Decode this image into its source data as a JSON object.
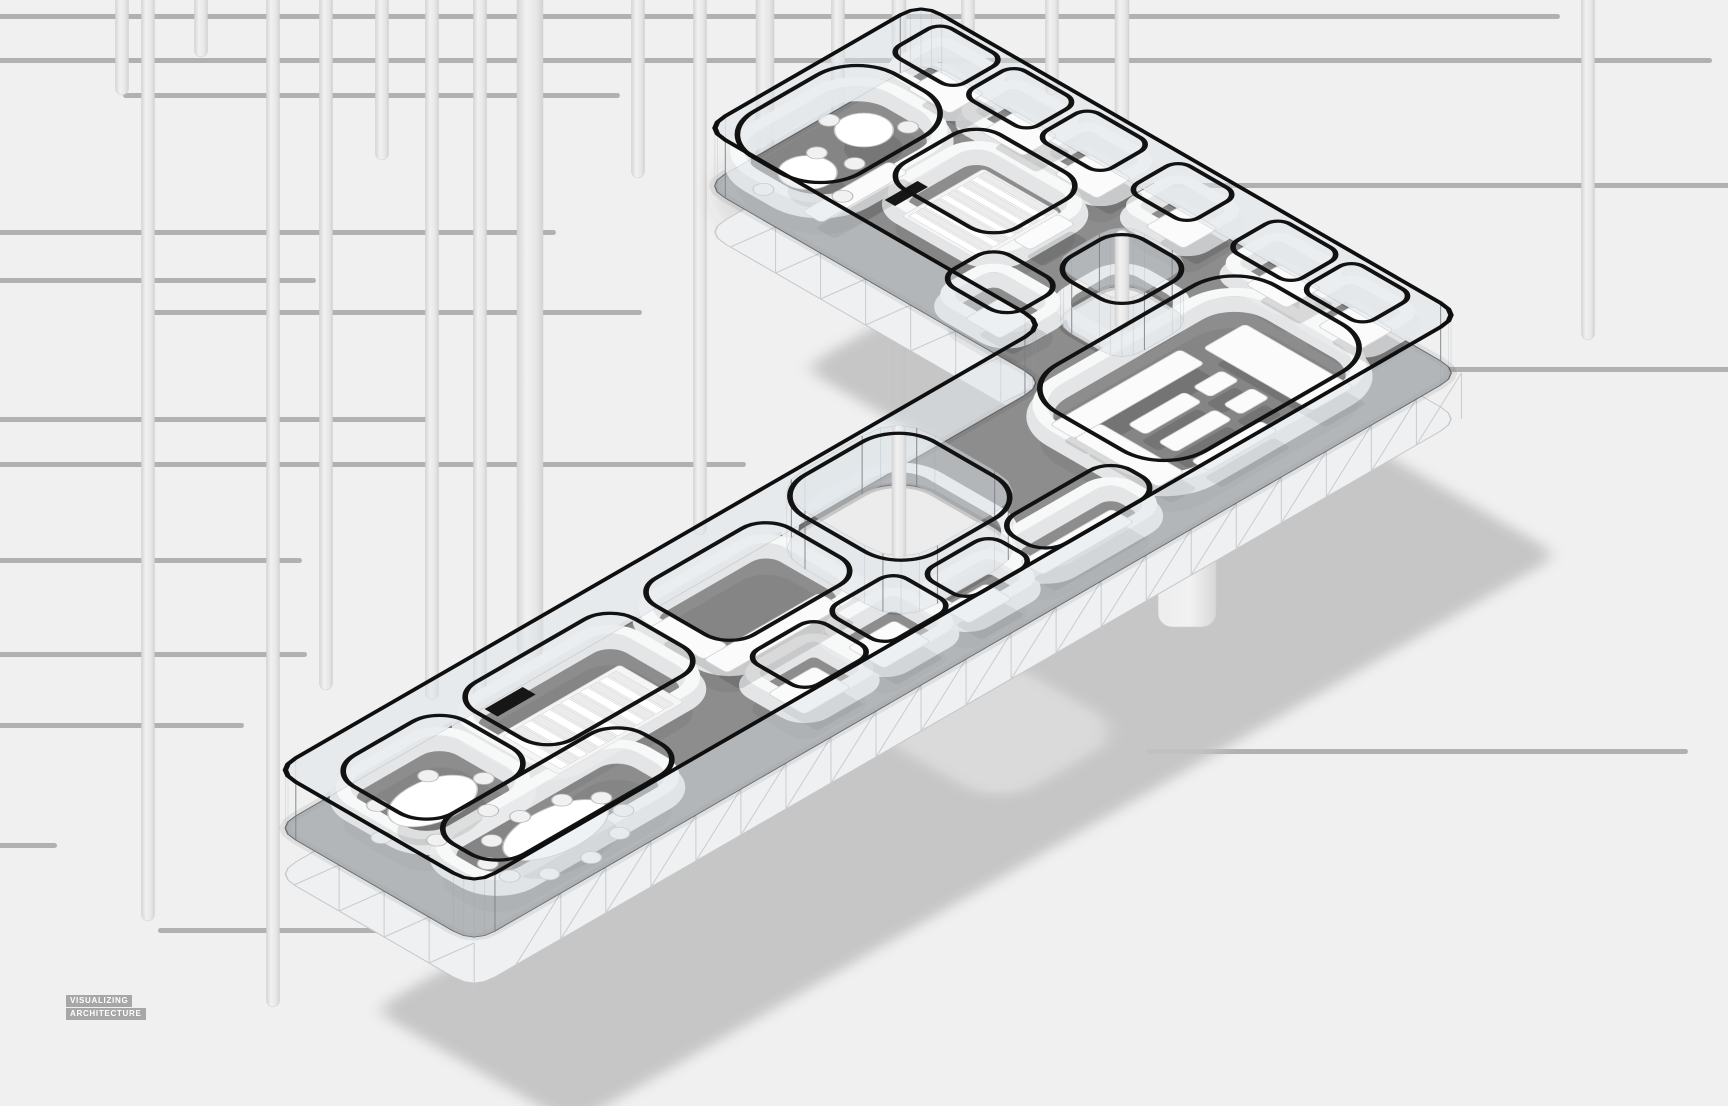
{
  "watermark": {
    "line1": "VISUALIZING",
    "line2": "ARCHITECTURE"
  },
  "palette": {
    "bg": "#f0f0f0",
    "h_line": "#b1b1b1",
    "rod_edge": "#d6d6d6",
    "rod_mid": "#f1f1f1",
    "floor": "#8d8d8d",
    "floor_edge": "rgba(35,35,35,0.75)",
    "wall_band": "#e9eaeb",
    "wall_hi": "#f7f8f8",
    "outline": "#121212",
    "rail": "#0f0f0f",
    "glass": "rgba(222,228,233,0.48)",
    "post": "rgba(118,124,130,0.75)",
    "fascia": "#eef0f2",
    "fascia_stroke": "#c5c8cb",
    "truss": "#c9cccf",
    "void_ground": "#ececec",
    "furn": "#fbfbfb",
    "furn_stroke": "#d4d6d8",
    "furn_shadow": "rgba(0,0,0,0.12)",
    "table": "#ffffff",
    "table_stroke": "#c6c6c6",
    "chair": "#f1f1f1",
    "chair_stroke": "#b9b9b9",
    "step_a": "#ffffff",
    "step_b": "#ececec",
    "step_stroke": "#d9d9d9",
    "black_bar": "#161616",
    "shadow": "#c3c3c3",
    "shadow_hole": "#d9d9d9",
    "pier_a": "#ededed",
    "pier_b": "#d7d7d7",
    "band_shadow": "rgba(70,70,70,0.12)",
    "wm_bg": "#a7a7a7",
    "wm_fg": "#ffffff"
  },
  "scene": {
    "proj": {
      "e": 275,
      "f": 770,
      "z_rail": 0,
      "z_outline": 6,
      "z_hi": 22,
      "z_band": 34,
      "z_floor": 58,
      "z_slab": 104
    },
    "background": {
      "h_lines": [
        [
          14,
          -20,
          1560
        ],
        [
          58,
          -20,
          1712
        ],
        [
          93,
          123,
          620
        ],
        [
          183,
          1030,
          1740
        ],
        [
          230,
          -20,
          556
        ],
        [
          278,
          -20,
          316
        ],
        [
          310,
          145,
          642
        ],
        [
          367,
          1330,
          1740
        ],
        [
          417,
          -20,
          436
        ],
        [
          462,
          -20,
          746
        ],
        [
          558,
          -20,
          302
        ],
        [
          652,
          -20,
          307
        ],
        [
          723,
          -20,
          244
        ],
        [
          749,
          1146,
          1688
        ],
        [
          843,
          -20,
          57
        ],
        [
          928,
          158,
          393
        ]
      ],
      "v_rods": [
        [
          122,
          -15,
          95,
          13
        ],
        [
          148,
          -15,
          921,
          13
        ],
        [
          201,
          -15,
          57,
          13
        ],
        [
          273,
          -15,
          1007,
          13
        ],
        [
          326,
          -15,
          690,
          13
        ],
        [
          382,
          -15,
          160,
          13
        ],
        [
          432,
          -15,
          700,
          13
        ],
        [
          480,
          -15,
          700,
          13
        ],
        [
          530,
          -15,
          660,
          26
        ],
        [
          638,
          -15,
          178,
          13
        ],
        [
          700,
          -15,
          535,
          13
        ],
        [
          765,
          -15,
          160,
          18
        ],
        [
          838,
          -15,
          150,
          13
        ],
        [
          899,
          -15,
          420,
          14
        ],
        [
          968,
          -15,
          40,
          13
        ],
        [
          1052,
          -15,
          95,
          13
        ],
        [
          1122,
          -15,
          125,
          14
        ],
        [
          1588,
          -15,
          340,
          13
        ]
      ],
      "band_shadow": {
        "x1": 750,
        "y1": 195,
        "x2": 1035,
        "y2": 360,
        "w": 70
      }
    },
    "shadow": {
      "dx": 98,
      "dy": 240,
      "blur": 7,
      "opacity": 0.92
    },
    "pier": {
      "x": 1158,
      "y": 545,
      "w": 58,
      "h": 82,
      "r": 14
    },
    "plate": {
      "outline": {
        "pts": [
          [
            0,
            0
          ],
          [
            890,
            0
          ],
          [
            890,
            -394
          ],
          [
            1140,
            -394
          ],
          [
            1140,
            230
          ],
          [
            0,
            230
          ]
        ],
        "r": 24
      },
      "post_spacing": 46,
      "truss_spacing": 52,
      "voids": [
        {
          "rect": [
            565,
            5,
            715,
            158
          ],
          "r": 42
        },
        {
          "rect": [
            954,
            -60,
            1038,
            24
          ],
          "r": 26
        }
      ],
      "rooms": [
        {
          "rect": [
            35,
            25,
            165,
            140
          ],
          "r": 32
        },
        {
          "rect": [
            35,
            140,
            255,
            222
          ],
          "r": 32
        },
        {
          "rect": [
            180,
            22,
            365,
            135
          ],
          "r": 30
        },
        {
          "rect": [
            390,
            22,
            545,
            135
          ],
          "r": 28
        },
        {
          "rect": [
            390,
            152,
            470,
            222
          ],
          "r": 16
        },
        {
          "rect": [
            482,
            152,
            562,
            222
          ],
          "r": 16
        },
        {
          "rect": [
            574,
            170,
            654,
            224
          ],
          "r": 16
        },
        {
          "rect": [
            666,
            165,
            800,
            224
          ],
          "r": 24
        },
        {
          "rect": [
            815,
            40,
            1068,
            212
          ],
          "r": 48
        },
        {
          "rect": [
            1078,
            20,
            1138,
            95
          ],
          "r": 14
        },
        {
          "rect": [
            1078,
            105,
            1138,
            178
          ],
          "r": 14
        },
        {
          "rect": [
            895,
            -388,
            1060,
            -265
          ],
          "r": 46
        },
        {
          "rect": [
            950,
            -250,
            1060,
            -120
          ],
          "r": 28
        },
        {
          "rect": [
            880,
            -115,
            945,
            -35
          ],
          "r": 20
        },
        {
          "rect": [
            1078,
            -370,
            1138,
            -295
          ],
          "r": 14
        },
        {
          "rect": [
            1078,
            -285,
            1138,
            -210
          ],
          "r": 14
        },
        {
          "rect": [
            1078,
            -200,
            1138,
            -125
          ],
          "r": 14
        },
        {
          "rect": [
            1078,
            -95,
            1138,
            -25
          ],
          "r": 14
        }
      ],
      "furniture": [
        [
          403,
          166,
          457,
          208
        ],
        [
          495,
          166,
          549,
          208
        ],
        [
          589,
          182,
          639,
          212
        ],
        [
          680,
          180,
          786,
          206
        ],
        [
          400,
          95,
          533,
          122
        ],
        [
          400,
          32,
          428,
          95
        ],
        [
          835,
          60,
          985,
          88
        ],
        [
          835,
          88,
          865,
          185
        ],
        [
          1000,
          72,
          1048,
          198
        ],
        [
          880,
          105,
          945,
          125
        ],
        [
          880,
          140,
          945,
          160
        ],
        [
          955,
          105,
          988,
          125
        ],
        [
          955,
          140,
          988,
          160
        ],
        [
          880,
          178,
          960,
          198
        ],
        [
          1088,
          33,
          1128,
          80
        ],
        [
          1088,
          116,
          1128,
          164
        ],
        [
          905,
          -296,
          1005,
          -274
        ],
        [
          998,
          -146,
          1050,
          -126
        ],
        [
          892,
          -95,
          933,
          -55
        ],
        [
          1088,
          -358,
          1128,
          -309
        ],
        [
          1088,
          -273,
          1128,
          -224
        ],
        [
          1088,
          -188,
          1128,
          -139
        ],
        [
          1088,
          -83,
          1128,
          -39
        ]
      ],
      "black_bars": [
        [
          212,
          30,
          256,
          45
        ],
        [
          952,
          -248,
          990,
          -236
        ]
      ],
      "stairs": [
        {
          "stringer": [
            205,
            48,
            350,
            122
          ],
          "a0": 212,
          "step": 11,
          "n": 12,
          "b1": 52,
          "b2": 118
        },
        {
          "stringer": [
            962,
            -238,
            1056,
            -150
          ],
          "a0": 966,
          "step": 9,
          "n": 10,
          "b1": -234,
          "b2": -154
        }
      ],
      "tables": [
        {
          "c": [
            100,
            82
          ],
          "rx": 44,
          "ry": 27,
          "chairs": 6,
          "start": 0
        },
        {
          "c": [
            142,
            182
          ],
          "rx": 54,
          "ry": 28,
          "chairs": 10,
          "start": 18
        },
        {
          "c": [
            945,
            -330
          ],
          "rx": 24,
          "ry": 24,
          "chairs": 3,
          "start": 85
        },
        {
          "c": [
            1020,
            -340
          ],
          "rx": 24,
          "ry": 24,
          "chairs": 3,
          "start": 25
        }
      ],
      "rod_overlays": [
        [
          899,
          425,
          560,
          14
        ],
        [
          1122,
          230,
          330,
          14
        ]
      ]
    }
  }
}
